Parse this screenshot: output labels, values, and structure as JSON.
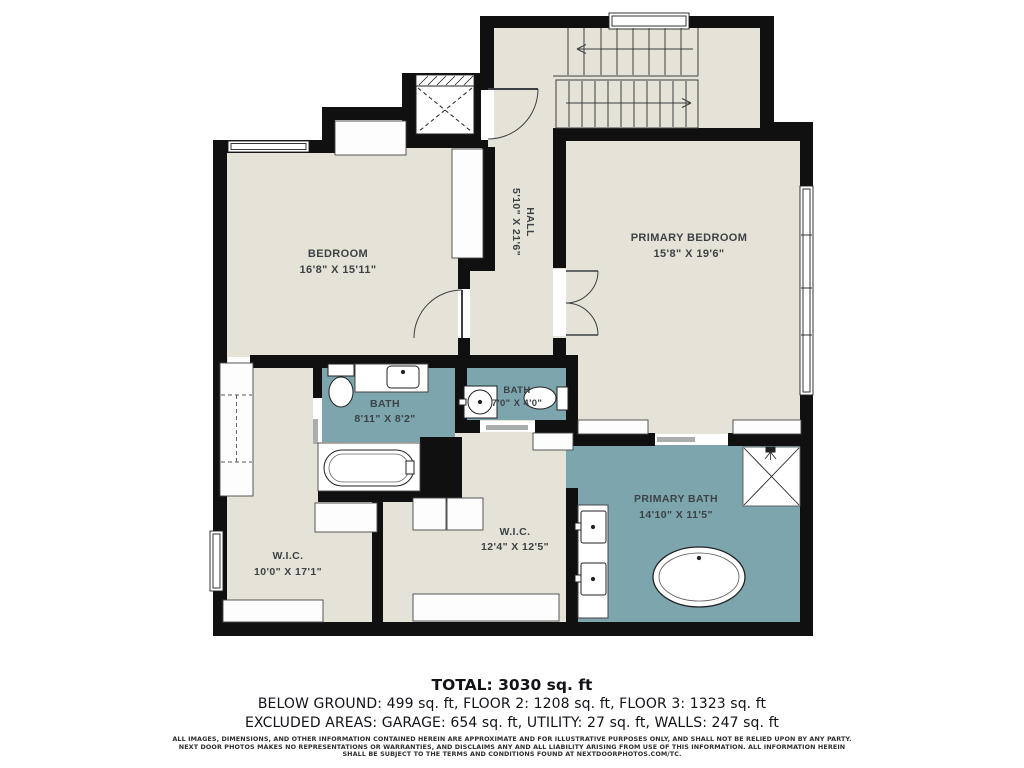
{
  "plan": {
    "rooms": [
      {
        "id": "bedroom",
        "name": "BEDROOM",
        "dims": "16'8\" X 15'11\""
      },
      {
        "id": "hall",
        "name": "HALL",
        "dims": "5'10\" X 21'6\""
      },
      {
        "id": "primary-bedroom",
        "name": "PRIMARY BEDROOM",
        "dims": "15'8\" X 19'6\""
      },
      {
        "id": "bath",
        "name": "BATH",
        "dims": "8'11\" X 8'2\""
      },
      {
        "id": "small-bath",
        "name": "BATH",
        "dims": "7'0\" X 4'0\""
      },
      {
        "id": "primary-bath",
        "name": "PRIMARY BATH",
        "dims": "14'10\" X 11'5\""
      },
      {
        "id": "wic-left",
        "name": "W.I.C.",
        "dims": "10'0\" X 17'1\""
      },
      {
        "id": "wic-right",
        "name": "W.I.C.",
        "dims": "12'4\" X 12'5\""
      }
    ],
    "colors": {
      "floor": "#E5E3D7",
      "wet_room": "#7CA5AE",
      "wall": "#101010",
      "threshold": "#A9ADAB",
      "line": "#3B3F43",
      "label_text": "#3C4246"
    }
  },
  "summary": {
    "total": "TOTAL: 3030 sq. ft",
    "floors": "BELOW GROUND: 499 sq. ft, FLOOR 2: 1208 sq. ft, FLOOR 3: 1323 sq. ft",
    "excluded": "EXCLUDED AREAS: GARAGE: 654 sq. ft, UTILITY: 27 sq. ft, WALLS: 247 sq. ft",
    "disclaimer_line1": "ALL IMAGES, DIMENSIONS, AND OTHER INFORMATION CONTAINED HEREIN ARE APPROXIMATE AND FOR ILLUSTRATIVE PURPOSES ONLY, AND SHALL NOT BE RELIED UPON BY ANY PARTY.",
    "disclaimer_line2": "NEXT DOOR PHOTOS MAKES NO REPRESENTATIONS OR WARRANTIES, AND DISCLAIMS ANY AND ALL LIABILITY ARISING FROM USE OF THIS INFORMATION. ALL INFORMATION HEREIN",
    "disclaimer_line3": "SHALL BE SUBJECT TO THE TERMS AND CONDITIONS FOUND AT NEXTDOORPHOTOS.COM/TC."
  }
}
